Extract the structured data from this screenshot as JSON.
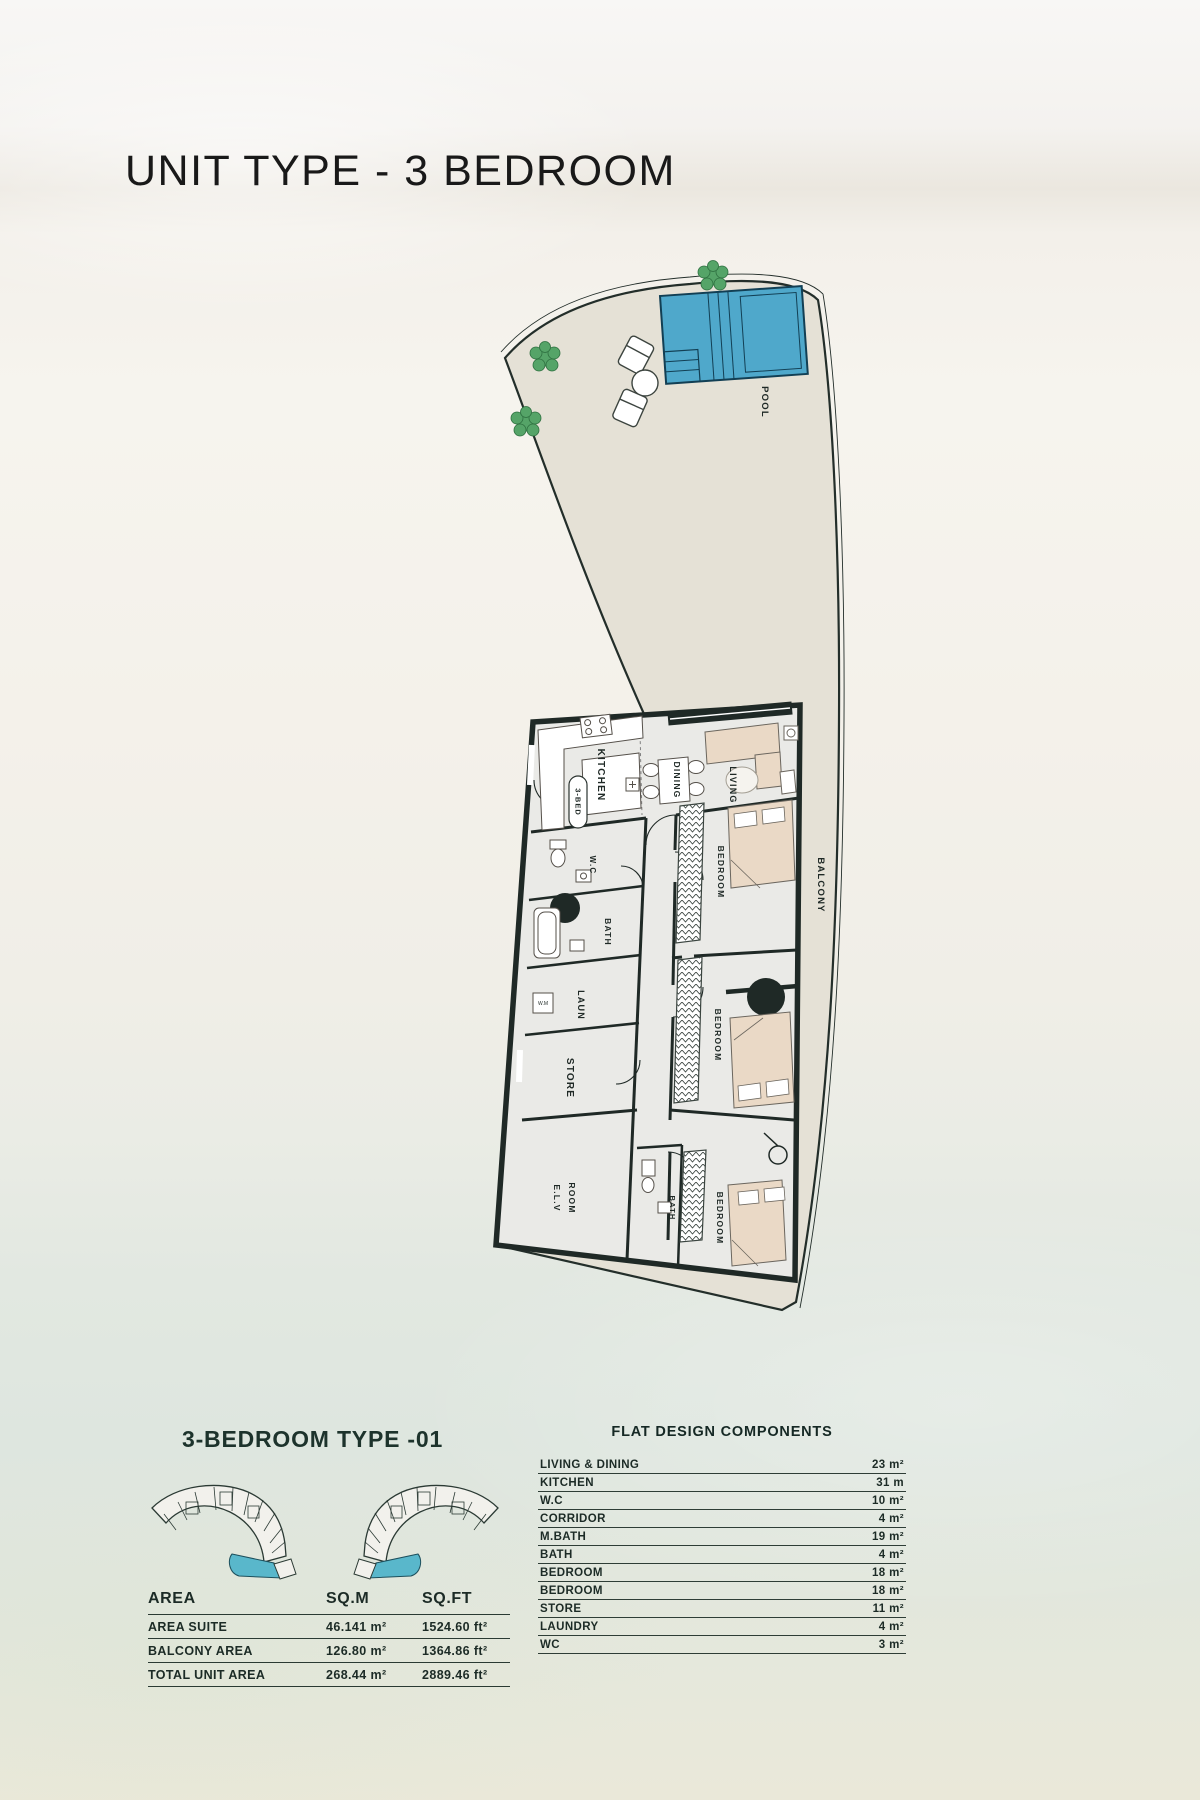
{
  "page": {
    "title": "UNIT TYPE - 3 BEDROOM"
  },
  "floor_plan": {
    "labels": {
      "pool": "POOL",
      "balcony": "BALCONY",
      "kitchen": "KITCHEN",
      "unit_tag": "3-BED",
      "dining": "DINING",
      "living": "LIVING",
      "wc": "W.C",
      "bath": "BATH",
      "laundry": "LAUN",
      "store": "STORE",
      "elv_line1": "E.L.V",
      "elv_line2": "ROOM",
      "bedroom": "BEDROOM",
      "washer": "W.M"
    }
  },
  "key_plan": {
    "heading": "3-BEDROOM TYPE -01"
  },
  "area_table": {
    "headers": [
      "AREA",
      "SQ.M",
      "SQ.FT"
    ],
    "rows": [
      {
        "label": "AREA SUITE",
        "sqm": "46.141 m²",
        "sqft": "1524.60 ft²"
      },
      {
        "label": "BALCONY AREA",
        "sqm": "126.80  m²",
        "sqft": "1364.86 ft²"
      },
      {
        "label": "TOTAL UNIT AREA",
        "sqm": "268.44 m²",
        "sqft": "2889.46 ft²"
      }
    ]
  },
  "components_table": {
    "heading": "FLAT DESIGN COMPONENTS",
    "rows": [
      {
        "label": "LIVING & DINING",
        "value": "23 m²"
      },
      {
        "label": "KITCHEN",
        "value": "31 m"
      },
      {
        "label": "W.C",
        "value": "10 m²"
      },
      {
        "label": "CORRIDOR",
        "value": "4 m²"
      },
      {
        "label": "M.BATH",
        "value": "19 m²"
      },
      {
        "label": "BATH",
        "value": "4 m²"
      },
      {
        "label": "BEDROOM",
        "value": "18 m²"
      },
      {
        "label": "BEDROOM",
        "value": "18 m²"
      },
      {
        "label": "STORE",
        "value": "11 m²"
      },
      {
        "label": "LAUNDRY",
        "value": "4 m²"
      },
      {
        "label": "WC",
        "value": "3 m²"
      }
    ]
  },
  "colors": {
    "pool": "#4FA8CB",
    "terrace": "#e5e1d6",
    "wall": "#1f2926",
    "accent_teal": "#59b7cb",
    "heading": "#1d332c"
  }
}
